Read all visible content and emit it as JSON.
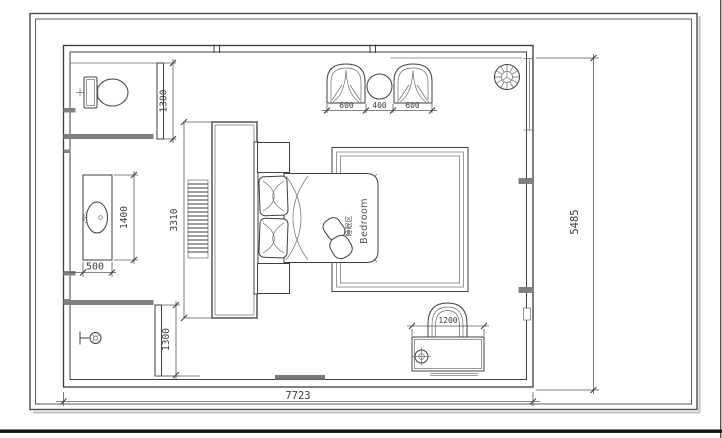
{
  "page": {
    "type": "cad-floor-plan",
    "room": {
      "label_cn": "睡眠区",
      "label_en": "Bedroom"
    },
    "dimensions": {
      "overall_width": "7723",
      "overall_height": "5485",
      "toilet_zone_depth": "1300",
      "vanity_length": "1400",
      "vanity_depth": "500",
      "shower_zone_depth": "1300",
      "cabinet_length": "3310",
      "armchair_left_width": "600",
      "side_table_width": "400",
      "armchair_right_width": "600",
      "desk_width": "1200"
    },
    "colors": {
      "line": "#3f3f3f",
      "wall_accent": "#808080",
      "paper": "#ffffff",
      "footer_bar": "#111111"
    }
  }
}
